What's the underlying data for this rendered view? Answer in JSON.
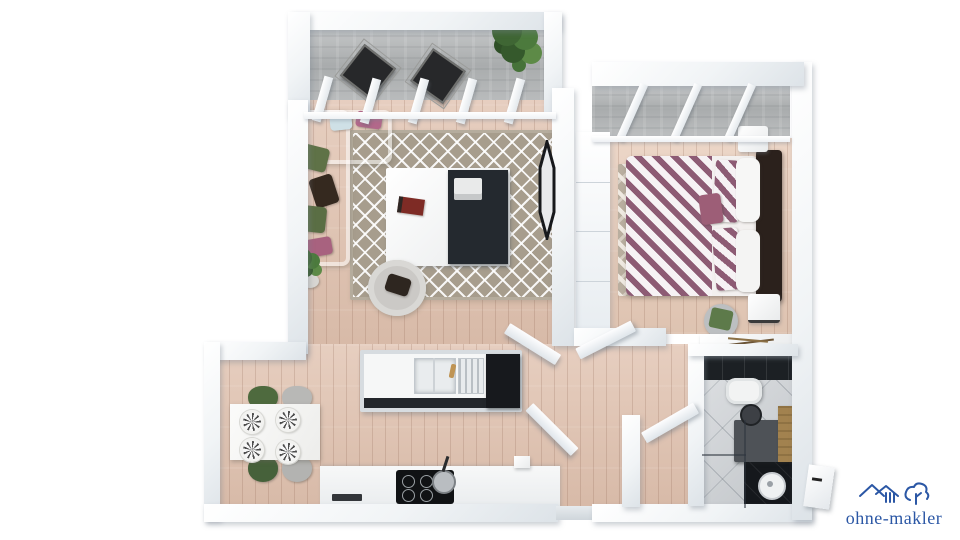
{
  "watermark": {
    "brand": "ohne-makler",
    "color": "#2b57a5"
  },
  "floorplan": {
    "style": "3d-rendered top-down apartment floor plan",
    "rooms": [
      {
        "id": "balcony",
        "features": [
          "two-black-folding-chairs",
          "potted-plant",
          "concrete-floor",
          "window-mullions"
        ]
      },
      {
        "id": "living-room",
        "features": [
          "l-shaped-sofa",
          "accent-pillows",
          "geometric-rug",
          "coffee-table",
          "armchair",
          "floor-plant",
          "wall-tv"
        ]
      },
      {
        "id": "bedroom",
        "features": [
          "double-bed-striped-duvet",
          "dark-headboard",
          "chevron-rug",
          "wardrobe",
          "two-nightstands",
          "green-stool",
          "sideboard",
          "skylight-beams"
        ]
      },
      {
        "id": "kitchen",
        "features": [
          "island-with-sink",
          "gold-faucet",
          "dark-cabinet-block",
          "cooktop-counter",
          "frying-pan",
          "oven-vent"
        ]
      },
      {
        "id": "dining-area",
        "features": [
          "white-table",
          "four-patterned-plates",
          "two-green-chairs",
          "two-grey-chairs"
        ]
      },
      {
        "id": "hallway",
        "features": [
          "entrance-opening",
          "open-doors",
          "closet-wall"
        ]
      },
      {
        "id": "bathroom",
        "features": [
          "black-tile-wall",
          "toilet",
          "round-basin",
          "dark-vanity",
          "wood-cabinet",
          "walk-in-shower",
          "glass-partition",
          "diagonal-grey-tiles"
        ]
      }
    ],
    "palette": {
      "wood_floor": "#e0c1ae",
      "wall_white": "#f1f4f6",
      "concrete": "#a9acad",
      "rug_taupe": "#a79d8d",
      "duvet_stripe": "#8d5b74",
      "pillow_green": "#5f7247",
      "pillow_mauve": "#b2688a",
      "dark_furniture": "#24292f",
      "black_tile": "#1c2024",
      "bath_tile": "#cbcfd3",
      "plant_green": "#3f6634",
      "logo_blue": "#2b57a5"
    }
  }
}
